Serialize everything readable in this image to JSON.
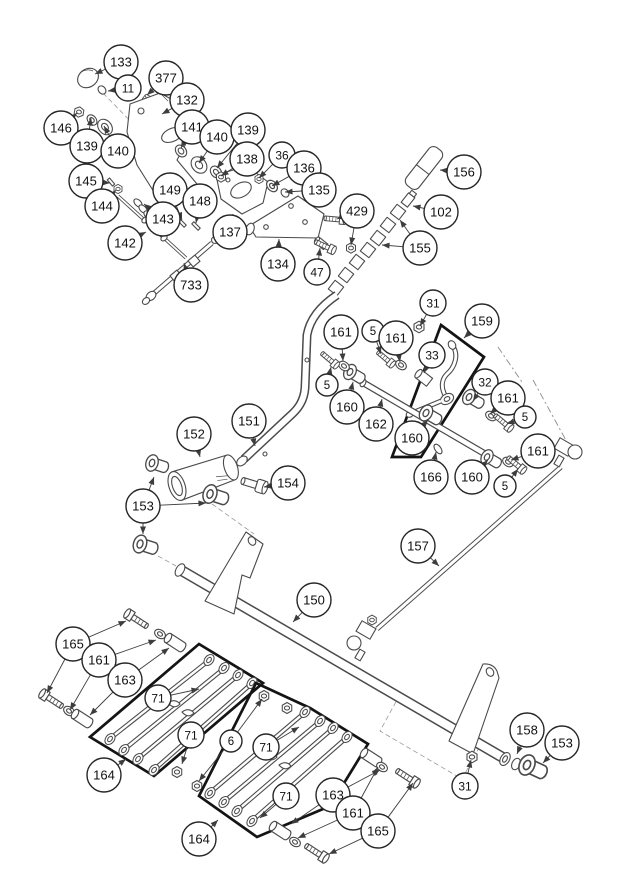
{
  "figure": {
    "type": "exploded-parts-diagram",
    "canvas": {
      "width": 620,
      "height": 876,
      "background": "#ffffff",
      "line_color": "#4a4a4a",
      "leader_color": "#3d3d3d",
      "balloon_fill": "#ffffff",
      "balloon_stroke": "#262626",
      "label_color": "#111111"
    }
  },
  "callouts": [
    {
      "label": "133",
      "x": 121,
      "y": 62,
      "r": 17,
      "arrows": [
        [
          95,
          74
        ]
      ]
    },
    {
      "label": "377",
      "x": 166,
      "y": 78,
      "r": 17,
      "arrows": [
        [
          147,
          95
        ]
      ]
    },
    {
      "label": "11",
      "x": 128,
      "y": 88,
      "r": 13,
      "arrows": [
        [
          108,
          91
        ]
      ]
    },
    {
      "label": "132",
      "x": 187,
      "y": 100,
      "r": 17,
      "arrows": [
        [
          162,
          114
        ]
      ]
    },
    {
      "label": "146",
      "x": 61,
      "y": 128,
      "r": 17,
      "arrows": [
        [
          77,
          113
        ]
      ]
    },
    {
      "label": "139",
      "x": 87,
      "y": 146,
      "r": 17,
      "arrows": [
        [
          91,
          118
        ]
      ]
    },
    {
      "label": "140",
      "x": 118,
      "y": 151,
      "r": 17,
      "arrows": [
        [
          104,
          126
        ]
      ]
    },
    {
      "label": "141",
      "x": 192,
      "y": 127,
      "r": 17,
      "arrows": [
        [
          181,
          148
        ]
      ]
    },
    {
      "label": "140",
      "x": 217,
      "y": 137,
      "r": 17,
      "arrows": [
        [
          199,
          163
        ]
      ]
    },
    {
      "label": "139",
      "x": 248,
      "y": 130,
      "r": 17,
      "arrows": [
        [
          217,
          168
        ]
      ]
    },
    {
      "label": "138",
      "x": 247,
      "y": 159,
      "r": 17,
      "arrows": [
        [
          221,
          176
        ]
      ]
    },
    {
      "label": "36",
      "x": 282,
      "y": 155,
      "r": 13,
      "arrows": [
        [
          259,
          178
        ]
      ]
    },
    {
      "label": "136",
      "x": 304,
      "y": 168,
      "r": 17,
      "arrows": [
        [
          272,
          186
        ]
      ]
    },
    {
      "label": "135",
      "x": 319,
      "y": 190,
      "r": 17,
      "arrows": [
        [
          285,
          192
        ]
      ]
    },
    {
      "label": "429",
      "x": 357,
      "y": 211,
      "r": 17,
      "arrows": [
        [
          337,
          219
        ],
        [
          351,
          245
        ]
      ]
    },
    {
      "label": "145",
      "x": 86,
      "y": 181,
      "r": 17,
      "arrows": [
        [
          110,
          183
        ]
      ]
    },
    {
      "label": "144",
      "x": 102,
      "y": 206,
      "r": 17,
      "arrows": [
        [
          116,
          190
        ]
      ]
    },
    {
      "label": "149",
      "x": 170,
      "y": 190,
      "r": 17,
      "arrows": [
        [
          182,
          220
        ]
      ]
    },
    {
      "label": "148",
      "x": 200,
      "y": 201,
      "r": 17,
      "arrows": [
        [
          196,
          223
        ]
      ]
    },
    {
      "label": "143",
      "x": 163,
      "y": 219,
      "r": 17,
      "arrows": [
        [
          144,
          204
        ]
      ]
    },
    {
      "label": "142",
      "x": 125,
      "y": 243,
      "r": 17,
      "arrows": [
        [
          146,
          232
        ]
      ]
    },
    {
      "label": "137",
      "x": 230,
      "y": 232,
      "r": 17,
      "arrows": [
        [
          233,
          214
        ]
      ]
    },
    {
      "label": "733",
      "x": 191,
      "y": 285,
      "r": 17,
      "arrows": [
        [
          184,
          263
        ]
      ]
    },
    {
      "label": "134",
      "x": 278,
      "y": 264,
      "r": 17,
      "arrows": [
        [
          279,
          239
        ]
      ]
    },
    {
      "label": "47",
      "x": 317,
      "y": 272,
      "r": 13,
      "arrows": [
        [
          320,
          248
        ]
      ]
    },
    {
      "label": "156",
      "x": 464,
      "y": 172,
      "r": 17,
      "arrows": [
        [
          440,
          170
        ]
      ]
    },
    {
      "label": "102",
      "x": 441,
      "y": 212,
      "r": 17,
      "arrows": [
        [
          413,
          206
        ]
      ]
    },
    {
      "label": "155",
      "x": 420,
      "y": 248,
      "r": 17,
      "arrows": [
        [
          400,
          220
        ],
        [
          382,
          245
        ]
      ]
    },
    {
      "label": "31",
      "x": 433,
      "y": 303,
      "r": 13,
      "arrows": [
        [
          420,
          326
        ]
      ]
    },
    {
      "label": "161",
      "x": 341,
      "y": 332,
      "r": 17,
      "arrows": [
        [
          343,
          361
        ]
      ]
    },
    {
      "label": "5",
      "x": 373,
      "y": 331,
      "r": 11,
      "arrows": [
        [
          381,
          354
        ]
      ]
    },
    {
      "label": "161",
      "x": 396,
      "y": 338,
      "r": 17,
      "arrows": [
        [
          400,
          362
        ]
      ]
    },
    {
      "label": "159",
      "x": 482,
      "y": 321,
      "r": 17,
      "arrows": [
        [
          464,
          338
        ]
      ]
    },
    {
      "label": "33",
      "x": 432,
      "y": 355,
      "r": 13,
      "arrows": [
        [
          424,
          373
        ]
      ]
    },
    {
      "label": "5",
      "x": 327,
      "y": 385,
      "r": 11,
      "arrows": [
        [
          331,
          367
        ]
      ]
    },
    {
      "label": "160",
      "x": 347,
      "y": 407,
      "r": 17,
      "arrows": [
        [
          353,
          382
        ]
      ]
    },
    {
      "label": "162",
      "x": 376,
      "y": 424,
      "r": 17,
      "arrows": [
        [
          382,
          399
        ]
      ]
    },
    {
      "label": "160",
      "x": 412,
      "y": 438,
      "r": 17,
      "arrows": [
        [
          428,
          420
        ]
      ]
    },
    {
      "label": "32",
      "x": 485,
      "y": 382,
      "r": 13,
      "arrows": [
        [
          473,
          401
        ]
      ]
    },
    {
      "label": "161",
      "x": 508,
      "y": 398,
      "r": 17,
      "arrows": [
        [
          490,
          414
        ]
      ]
    },
    {
      "label": "5",
      "x": 525,
      "y": 417,
      "r": 11,
      "arrows": [
        [
          507,
          424
        ]
      ]
    },
    {
      "label": "166",
      "x": 431,
      "y": 477,
      "r": 17,
      "arrows": [
        [
          436,
          452
        ]
      ]
    },
    {
      "label": "160",
      "x": 472,
      "y": 477,
      "r": 17,
      "arrows": [
        [
          488,
          460
        ]
      ]
    },
    {
      "label": "161",
      "x": 538,
      "y": 451,
      "r": 17,
      "arrows": [
        [
          511,
          460
        ]
      ]
    },
    {
      "label": "5",
      "x": 505,
      "y": 486,
      "r": 11,
      "arrows": [
        [
          518,
          469
        ]
      ]
    },
    {
      "label": "152",
      "x": 194,
      "y": 434,
      "r": 17,
      "arrows": [
        [
          200,
          457
        ]
      ]
    },
    {
      "label": "151",
      "x": 249,
      "y": 421,
      "r": 17,
      "arrows": [
        [
          255,
          446
        ]
      ]
    },
    {
      "label": "154",
      "x": 288,
      "y": 483,
      "r": 17,
      "arrows": [
        [
          264,
          487
        ]
      ]
    },
    {
      "label": "153",
      "x": 143,
      "y": 506,
      "r": 17,
      "arrows": [
        [
          154,
          477
        ],
        [
          206,
          503
        ],
        [
          143,
          534
        ]
      ]
    },
    {
      "label": "150",
      "x": 314,
      "y": 600,
      "r": 17,
      "arrows": [
        [
          293,
          622
        ]
      ]
    },
    {
      "label": "157",
      "x": 418,
      "y": 546,
      "r": 17,
      "arrows": [
        [
          439,
          566
        ]
      ]
    },
    {
      "label": "158",
      "x": 527,
      "y": 730,
      "r": 17,
      "arrows": [
        [
          517,
          754
        ]
      ]
    },
    {
      "label": "153",
      "x": 562,
      "y": 743,
      "r": 17,
      "arrows": [
        [
          543,
          763
        ]
      ]
    },
    {
      "label": "31",
      "x": 465,
      "y": 786,
      "r": 13,
      "arrows": [
        [
          471,
          760
        ]
      ]
    },
    {
      "label": "165",
      "x": 73,
      "y": 644,
      "r": 17,
      "arrows": [
        [
          126,
          621
        ],
        [
          47,
          693
        ]
      ]
    },
    {
      "label": "161",
      "x": 99,
      "y": 660,
      "r": 17,
      "arrows": [
        [
          156,
          640
        ],
        [
          70,
          710
        ]
      ]
    },
    {
      "label": "163",
      "x": 125,
      "y": 680,
      "r": 17,
      "arrows": [
        [
          169,
          648
        ],
        [
          90,
          715
        ]
      ]
    },
    {
      "label": "71",
      "x": 158,
      "y": 698,
      "r": 13,
      "arrows": [
        [
          199,
          689
        ]
      ]
    },
    {
      "label": "71",
      "x": 191,
      "y": 735,
      "r": 13,
      "arrows": [
        [
          182,
          764
        ]
      ]
    },
    {
      "label": "164",
      "x": 104,
      "y": 775,
      "r": 17,
      "arrows": [
        [
          126,
          759
        ]
      ]
    },
    {
      "label": "6",
      "x": 231,
      "y": 741,
      "r": 11,
      "arrows": [
        [
          262,
          699
        ],
        [
          199,
          781
        ]
      ]
    },
    {
      "label": "71",
      "x": 266,
      "y": 747,
      "r": 13,
      "arrows": [
        [
          299,
          727
        ]
      ]
    },
    {
      "label": "71",
      "x": 286,
      "y": 796,
      "r": 13,
      "arrows": [
        [
          260,
          818
        ]
      ]
    },
    {
      "label": "163",
      "x": 333,
      "y": 795,
      "r": 17,
      "arrows": [
        [
          380,
          770
        ],
        [
          291,
          824
        ]
      ]
    },
    {
      "label": "161",
      "x": 353,
      "y": 813,
      "r": 17,
      "arrows": [
        [
          378,
          767
        ],
        [
          298,
          838
        ]
      ]
    },
    {
      "label": "165",
      "x": 378,
      "y": 831,
      "r": 17,
      "arrows": [
        [
          413,
          783
        ],
        [
          329,
          854
        ]
      ]
    },
    {
      "label": "164",
      "x": 199,
      "y": 839,
      "r": 17,
      "arrows": [
        [
          218,
          820
        ]
      ]
    }
  ]
}
